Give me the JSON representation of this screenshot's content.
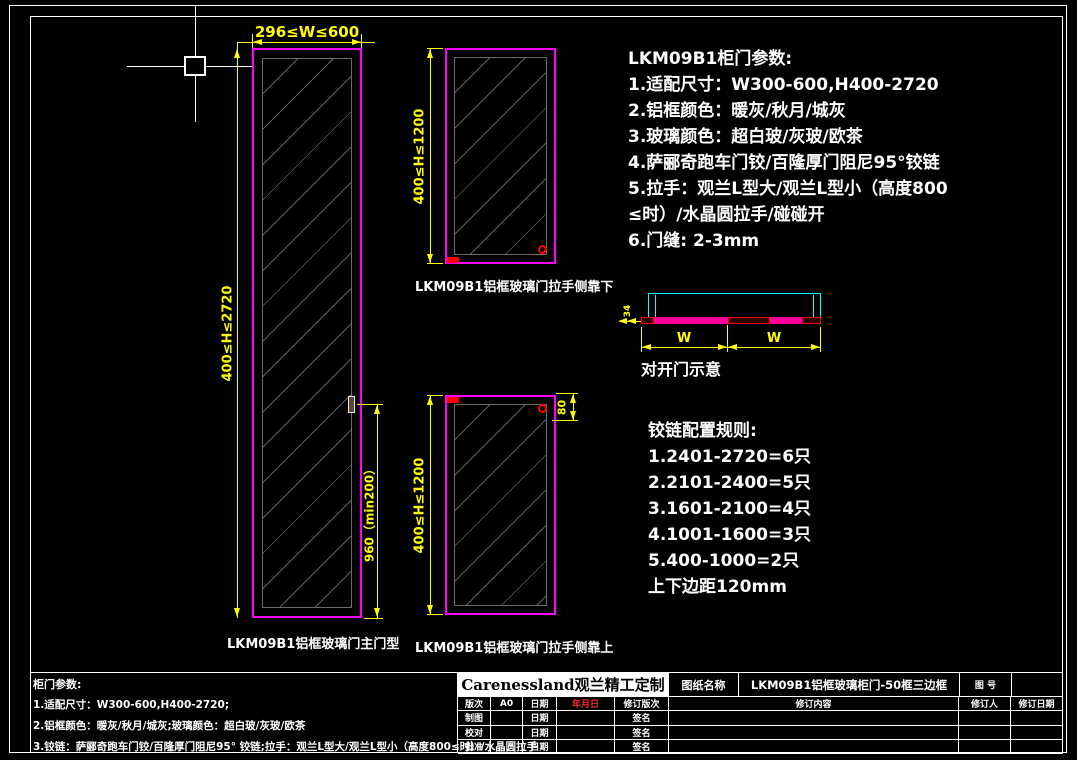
{
  "colors": {
    "background": "#000000",
    "frame_border": "#ffffff",
    "door_frame": "#ff00ff",
    "dimension": "#ffff00",
    "glass_line": "#5f5f5f",
    "accent_red": "#ff0000",
    "section_cyan": "#00ffff",
    "section_bar": "#ff0099",
    "logo_bg": "#ffffff",
    "revision_date": "#ff2a2a"
  },
  "spec_panel": {
    "title": "LKM09B1柜门参数:",
    "lines": [
      "1.适配尺寸：W300-600,H400-2720",
      "2.铝框颜色：暖灰/秋月/城灰",
      "3.玻璃颜色：超白玻/灰玻/欧茶",
      "4.萨郦奇跑车门铰/百隆厚门阻尼95°铰链",
      "5.拉手：观兰L型大/观兰L型小（高度800",
      "≤时）/水晶圆拉手/碰碰开",
      "6.门缝: 2-3mm"
    ]
  },
  "hinge_panel": {
    "title": "铰链配置规则:",
    "lines": [
      "1.2401-2720=6只",
      "2.2101-2400=5只",
      "3.1601-2100=4只",
      "4.1001-1600=3只",
      "5.400-1000=2只",
      "上下边距120mm"
    ]
  },
  "doors": {
    "main": {
      "label": "LKM09B1铝框玻璃门主门型",
      "width_dim": "296≤W≤600",
      "height_dim": "400≤H≤2720",
      "handle_dim": "960（min200）"
    },
    "handle_bottom": {
      "label": "LKM09B1铝框玻璃门拉手侧靠下",
      "height_dim": "400≤H≤1200"
    },
    "handle_top": {
      "label": "LKM09B1铝框玻璃门拉手侧靠上",
      "height_dim": "400≤H≤1200",
      "handle_offset_dim": "80"
    }
  },
  "double_door": {
    "caption": "对开门示意",
    "left_width_label": "W",
    "right_width_label": "W",
    "thickness_dim": "34"
  },
  "footer_params": {
    "title": "柜门参数:",
    "lines": [
      "1.适配尺寸：W300-600,H400-2720;",
      "2.铝框颜色：暖灰/秋月/城灰;玻璃颜色：超白玻/灰玻/欧茶",
      "3.铰链：萨郦奇跑车门铰/百隆厚门阻尼95° 铰链;拉手：观兰L型大/观兰L型小（高度800≤时）/水晶圆拉手"
    ]
  },
  "title_block": {
    "logo": "Carenessland观兰精工定制",
    "drawing_name_label": "图纸名称",
    "drawing_name": "LKM09B1铝框玻璃柜门-50框三边框",
    "drawing_no_label": "图 号",
    "header_row": {
      "rev_label": "版次",
      "rev_value": "A0",
      "date_label": "日期",
      "date_value": "年月日",
      "rev_no_label": "修订版次",
      "rev_content_label": "修订内容",
      "revisor_label": "修订人",
      "rev_date_label": "修订日期"
    },
    "sign_rows": [
      {
        "label": "制图",
        "date_label": "日期",
        "sign_label": "签名"
      },
      {
        "label": "校对",
        "date_label": "日期",
        "sign_label": "签名"
      },
      {
        "label": "批准",
        "date_label": "日期",
        "sign_label": "签名"
      }
    ]
  }
}
